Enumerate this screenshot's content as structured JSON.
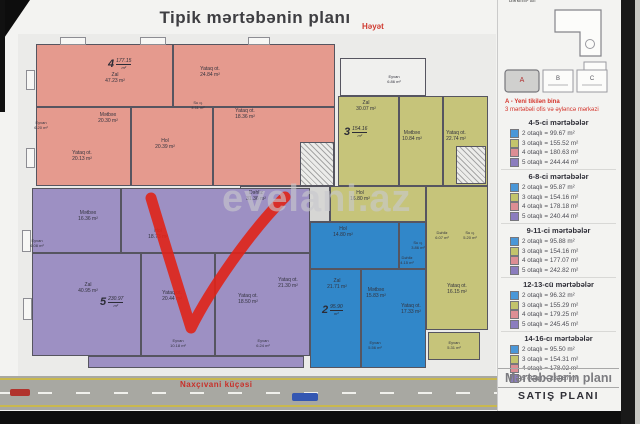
{
  "title": "Tipik mərtəbənin planı",
  "yard_label": "Həyət",
  "watermark": "evelani.az",
  "road": {
    "street_label": "Naxçıvani küçəsi"
  },
  "sidebar": {
    "cutoff_top": "Bərkimli- arı",
    "site": {
      "blocks": [
        "A",
        "B",
        "C"
      ],
      "note1": "A - Yeni tikilən bina",
      "note2": "3 mərtəbəli ofis və əyləncə mərkəzi"
    },
    "legend": [
      {
        "title": "4-5-ci mərtəbələr",
        "items": [
          {
            "color": "#4a97d8",
            "label": "2 otaqlı = 99.67 m²"
          },
          {
            "color": "#c3c46c",
            "label": "3 otaqlı = 155.52 m²"
          },
          {
            "color": "#dc8e94",
            "label": "4 otaqlı = 180.63 m²"
          },
          {
            "color": "#8b7dbe",
            "label": "5 otaqlı = 244.44 m²"
          }
        ]
      },
      {
        "title": "6-8-ci mərtəbələr",
        "items": [
          {
            "color": "#4a97d8",
            "label": "2 otaqlı = 95.87 m²"
          },
          {
            "color": "#c3c46c",
            "label": "3 otaqlı = 154.16 m²"
          },
          {
            "color": "#dc8e94",
            "label": "4 otaqlı = 178.18 m²"
          },
          {
            "color": "#8b7dbe",
            "label": "5 otaqlı = 240.44 m²"
          }
        ]
      },
      {
        "title": "9-11-ci mərtəbələr",
        "items": [
          {
            "color": "#4a97d8",
            "label": "2 otaqlı = 95.88 m²"
          },
          {
            "color": "#c3c46c",
            "label": "3 otaqlı = 154.16 m²"
          },
          {
            "color": "#dc8e94",
            "label": "4 otaqlı = 177.07 m²"
          },
          {
            "color": "#8b7dbe",
            "label": "5 otaqlı = 242.82 m²"
          }
        ]
      },
      {
        "title": "12-13-cü mərtəbələr",
        "items": [
          {
            "color": "#4a97d8",
            "label": "2 otaqlı = 96.32 m²"
          },
          {
            "color": "#c3c46c",
            "label": "3 otaqlı = 155.29 m²"
          },
          {
            "color": "#dc8e94",
            "label": "4 otaqlı = 179.25 m²"
          },
          {
            "color": "#8b7dbe",
            "label": "5 otaqlı = 245.45 m²"
          }
        ]
      },
      {
        "title": "14-16-cı mərtəbələr",
        "items": [
          {
            "color": "#4a97d8",
            "label": "2 otaqlı = 95.50 m²"
          },
          {
            "color": "#c3c46c",
            "label": "3 otaqlı = 154.31 m²"
          },
          {
            "color": "#dc8e94",
            "label": "4 otaqlı = 178.02 m²"
          },
          {
            "color": "#8b7dbe",
            "label": "5 otaqlı = 234.87 m²"
          }
        ]
      }
    ],
    "footer1": "Mərtəbələrin planı",
    "footer2": "SATIŞ PLANI"
  },
  "plan": {
    "zones": [
      {
        "name": "pink-4room",
        "color": "#e59a8e",
        "x": 36,
        "y": 44,
        "w": 299,
        "h": 142
      },
      {
        "name": "terrace-white",
        "color": "#f0f0ee",
        "x": 340,
        "y": 58,
        "w": 86,
        "h": 38
      },
      {
        "name": "yellow-3room",
        "color": "#c6c47a",
        "x": 338,
        "y": 96,
        "w": 150,
        "h": 90
      },
      {
        "name": "corridor-gray",
        "color": "#d6d6d4",
        "x": 240,
        "y": 186,
        "w": 90,
        "h": 36
      },
      {
        "name": "yellow-hol",
        "color": "#c6c47a",
        "x": 330,
        "y": 186,
        "w": 96,
        "h": 36
      },
      {
        "name": "yellow-right",
        "color": "#c6c47a",
        "x": 426,
        "y": 186,
        "w": 62,
        "h": 144
      },
      {
        "name": "yellow-eyvan",
        "color": "#c6c47a",
        "x": 428,
        "y": 332,
        "w": 52,
        "h": 28
      },
      {
        "name": "purple-5room",
        "color": "#9d90c3",
        "x": 32,
        "y": 188,
        "w": 278,
        "h": 168
      },
      {
        "name": "purple-eyvan-strip",
        "color": "#9d90c3",
        "x": 88,
        "y": 356,
        "w": 216,
        "h": 12
      },
      {
        "name": "blue-2room",
        "color": "#3187c9",
        "x": 310,
        "y": 222,
        "w": 116,
        "h": 146
      }
    ],
    "stairs": [
      {
        "x": 300,
        "y": 142,
        "w": 34,
        "h": 44
      },
      {
        "x": 456,
        "y": 146,
        "w": 30,
        "h": 38
      }
    ],
    "balconies": [
      {
        "x": 60,
        "y": 37,
        "w": 26,
        "h": 8
      },
      {
        "x": 140,
        "y": 37,
        "w": 26,
        "h": 8
      },
      {
        "x": 248,
        "y": 37,
        "w": 22,
        "h": 8
      },
      {
        "x": 26,
        "y": 70,
        "w": 9,
        "h": 20
      },
      {
        "x": 26,
        "y": 148,
        "w": 9,
        "h": 20
      },
      {
        "x": 22,
        "y": 230,
        "w": 9,
        "h": 22
      },
      {
        "x": 23,
        "y": 298,
        "w": 9,
        "h": 22
      }
    ],
    "walls": [
      {
        "x": 172,
        "y": 44,
        "w": 2,
        "h": 64
      },
      {
        "x": 36,
        "y": 106,
        "w": 299,
        "h": 2
      },
      {
        "x": 130,
        "y": 106,
        "w": 2,
        "h": 80
      },
      {
        "x": 212,
        "y": 106,
        "w": 2,
        "h": 80
      },
      {
        "x": 398,
        "y": 96,
        "w": 2,
        "h": 90
      },
      {
        "x": 442,
        "y": 96,
        "w": 2,
        "h": 90
      },
      {
        "x": 32,
        "y": 252,
        "w": 278,
        "h": 2
      },
      {
        "x": 120,
        "y": 188,
        "w": 2,
        "h": 64
      },
      {
        "x": 140,
        "y": 252,
        "w": 2,
        "h": 104
      },
      {
        "x": 214,
        "y": 252,
        "w": 2,
        "h": 104
      },
      {
        "x": 360,
        "y": 268,
        "w": 2,
        "h": 100
      },
      {
        "x": 310,
        "y": 268,
        "w": 116,
        "h": 2
      },
      {
        "x": 398,
        "y": 222,
        "w": 2,
        "h": 46
      }
    ],
    "rooms": [
      {
        "t": "Zal",
        "a": "47.23 m²",
        "x": 85,
        "y": 72,
        "w": 60
      },
      {
        "t": "Yataq ot.",
        "a": "24.84 m²",
        "x": 180,
        "y": 66,
        "w": 60
      },
      {
        "t": "Yataq ot.",
        "a": "18.36 m²",
        "x": 215,
        "y": 108,
        "w": 60
      },
      {
        "t": "Mətbəx",
        "a": "20.30 m²",
        "x": 78,
        "y": 112,
        "w": 60
      },
      {
        "t": "Hol",
        "a": "20.39 m²",
        "x": 135,
        "y": 138,
        "w": 60
      },
      {
        "t": "Yataq ot.",
        "a": "20.13 m²",
        "x": 52,
        "y": 150,
        "w": 60
      },
      {
        "t": "Su q.",
        "a": "4.11 m²",
        "x": 178,
        "y": 100,
        "w": 40,
        "fs": 4
      },
      {
        "t": "Eyvan",
        "a": "6.20 m²",
        "x": 26,
        "y": 120,
        "w": 30,
        "fs": 4
      },
      {
        "t": "Zal",
        "a": "30.07 m²",
        "x": 336,
        "y": 100,
        "w": 60
      },
      {
        "t": "Mətbəx",
        "a": "10.84 m²",
        "x": 384,
        "y": 130,
        "w": 56
      },
      {
        "t": "Yataq ot.",
        "a": "22.74 m²",
        "x": 426,
        "y": 130,
        "w": 60
      },
      {
        "t": "Eyvan",
        "a": "6.86 m²",
        "x": 372,
        "y": 74,
        "w": 44,
        "fs": 4
      },
      {
        "t": "Dəhliz",
        "a": "31.36 m²",
        "x": 226,
        "y": 190,
        "w": 60
      },
      {
        "t": "Hol",
        "a": "16.80 m²",
        "x": 330,
        "y": 190,
        "w": 60
      },
      {
        "t": "Yataq ot.",
        "a": "16.15 m²",
        "x": 427,
        "y": 283,
        "w": 60
      },
      {
        "t": "Eyvan",
        "a": "5.31 m²",
        "x": 430,
        "y": 340,
        "w": 48,
        "fs": 4
      },
      {
        "t": "Dəhliz",
        "a": "6.07 m²",
        "x": 424,
        "y": 230,
        "w": 36,
        "fs": 4
      },
      {
        "t": "Su q.",
        "a": "5.20 m²",
        "x": 452,
        "y": 230,
        "w": 36,
        "fs": 4
      },
      {
        "t": "Mətbəx",
        "a": "16.36 m²",
        "x": 58,
        "y": 210,
        "w": 60
      },
      {
        "t": "Hol",
        "a": "18.73 m²",
        "x": 128,
        "y": 228,
        "w": 60
      },
      {
        "t": "Zal",
        "a": "40.95 m²",
        "x": 58,
        "y": 282,
        "w": 60
      },
      {
        "t": "Yataq ot.",
        "a": "20.44 m²",
        "x": 142,
        "y": 290,
        "w": 60
      },
      {
        "t": "Yataq ot.",
        "a": "18.50 m²",
        "x": 218,
        "y": 293,
        "w": 60
      },
      {
        "t": "Yataq ot.",
        "a": "21.30 m²",
        "x": 258,
        "y": 277,
        "w": 60
      },
      {
        "t": "Eyvan",
        "a": "10.18 m²",
        "x": 155,
        "y": 338,
        "w": 46,
        "fs": 4
      },
      {
        "t": "Eyvan",
        "a": "6.24 m²",
        "x": 242,
        "y": 338,
        "w": 42,
        "fs": 4
      },
      {
        "t": "Eyvan",
        "a": "6.08 m²",
        "x": 22,
        "y": 238,
        "w": 30,
        "fs": 4
      },
      {
        "t": "Hol",
        "a": "14.80 m²",
        "x": 318,
        "y": 226,
        "w": 50
      },
      {
        "t": "Zal",
        "a": "21.71 m²",
        "x": 312,
        "y": 278,
        "w": 50
      },
      {
        "t": "Mətbəx",
        "a": "15.83 m²",
        "x": 350,
        "y": 287,
        "w": 52
      },
      {
        "t": "Yataq ot.",
        "a": "17.33 m²",
        "x": 385,
        "y": 303,
        "w": 52
      },
      {
        "t": "Eyvan",
        "a": "5.56 m²",
        "x": 352,
        "y": 340,
        "w": 46,
        "fs": 4
      },
      {
        "t": "Dəhliz",
        "a": "4.15 m²",
        "x": 390,
        "y": 255,
        "w": 34,
        "fs": 4
      },
      {
        "t": "Su q.",
        "a": "3.86 m²",
        "x": 402,
        "y": 240,
        "w": 32,
        "fs": 4
      }
    ],
    "markers": [
      {
        "num": "4",
        "val": "177.15",
        "unit": "m²",
        "x": 108,
        "y": 58
      },
      {
        "num": "3",
        "val": "154.16",
        "unit": "m²",
        "x": 344,
        "y": 126
      },
      {
        "num": "5",
        "val": "230.97",
        "unit": "m²",
        "x": 100,
        "y": 296
      },
      {
        "num": "2",
        "val": "95.90",
        "unit": "m²",
        "x": 322,
        "y": 304
      }
    ]
  },
  "colors": {
    "red_marker": "#e02318",
    "zone_pink": "#e59a8e",
    "zone_yellow": "#c6c47a",
    "zone_purple": "#9d90c3",
    "zone_blue": "#3187c9"
  }
}
